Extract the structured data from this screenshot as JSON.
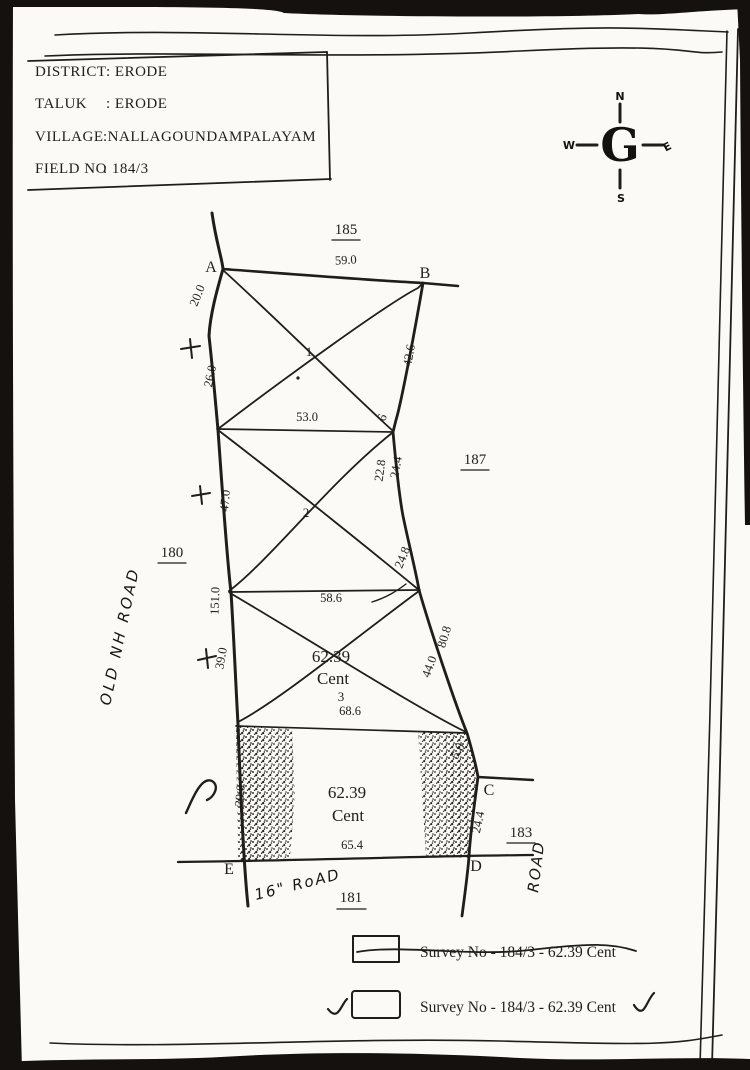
{
  "colors": {
    "paper": "#fbfaf7",
    "ink": "#211d19",
    "scan_edge": "#14110f"
  },
  "header": {
    "rows": [
      {
        "label": "DISTRICT",
        "value": ": ERODE"
      },
      {
        "label": "TALUK",
        "value": ": ERODE"
      },
      {
        "label": "VILLAGE",
        "value": ":NALLAGOUNDAMPALAYAM"
      },
      {
        "label": "FIELD NO",
        "value": ": 184/3"
      }
    ]
  },
  "compass": {
    "north": "N",
    "east": "E",
    "south": "S",
    "west": "W",
    "glyph": "G"
  },
  "adjacent_survey_numbers": {
    "top": "185",
    "right": "187",
    "left": "180",
    "bottom_right": "183",
    "bottom": "181"
  },
  "vertices": {
    "a": "A",
    "b": "B",
    "c": "C",
    "d": "D",
    "e": "E"
  },
  "stations": {
    "s1": "1",
    "s2": "2",
    "s3": "3"
  },
  "areas": {
    "upper_value": "62.39",
    "upper_unit": "Cent",
    "lower_value": "62.39",
    "lower_unit": "Cent"
  },
  "measurements": {
    "top_ab": "59.0",
    "left_upper1": "20.0",
    "left_upper2": "26.0",
    "right_b": "42.6",
    "cross_line1": "53.0",
    "offset_tick": "6",
    "right_mid1": "22.8",
    "right_mid2": "24.4",
    "left_mid": "47.0",
    "right_mid3": "24.8",
    "left_lower": "151.0",
    "cross_line2": "58.6",
    "left_plot3": "39.0",
    "right_lower1": "80.8",
    "right_lower2": "44.0",
    "cross_line3": "68.6",
    "corner_c": "5.0",
    "side_cd": "24.4",
    "left_bottom": "39.0",
    "bottom_ed": "65.4"
  },
  "roads": {
    "left": "OLD NH ROAD",
    "right": "ROAD",
    "bottom": "16\" RoAD"
  },
  "legend": {
    "item1": {
      "text": "Survey No - 184/3  - 62.39 Cent"
    },
    "item2": {
      "text": "Survey No - 184/3  - 62.39 Cent"
    }
  }
}
